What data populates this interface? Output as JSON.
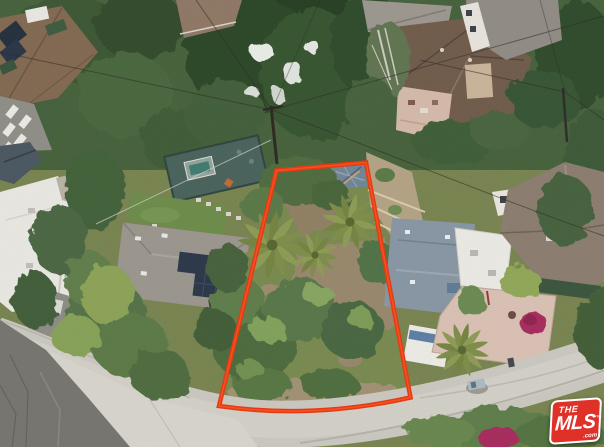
{
  "scene": {
    "kind": "aerial-drone-photo",
    "description": "Aerial drone view of a hillside residential neighborhood; an overgrown vacant lot with palm trees is outlined in red-orange, bordered by a curving concrete street below and houses on all sides",
    "outline_color": "#e8360e",
    "street_color": "#c9c6be",
    "vegetation_color": "#44603a"
  },
  "watermark": {
    "the": "THE",
    "mls": "MLS",
    "tm": "™",
    "com": ".com",
    "bg_color": "#e03128",
    "text_color": "#ffffff"
  }
}
